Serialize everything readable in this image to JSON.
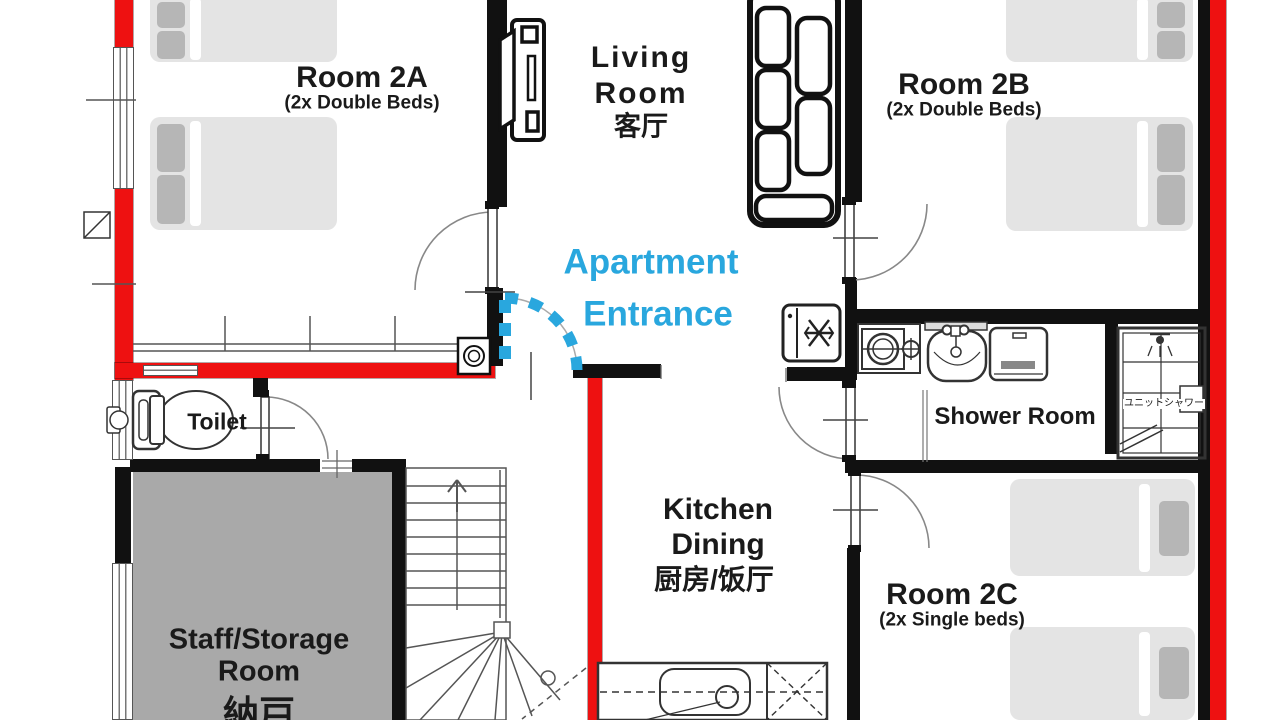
{
  "rooms": {
    "room_2a": {
      "name": "Room 2A",
      "subtitle": "(2x Double Beds)"
    },
    "living_room": {
      "name_line1": "Living",
      "name_line2": "Room",
      "name_cjk": "客厅"
    },
    "room_2b": {
      "name": "Room 2B",
      "subtitle": "(2x Double Beds)"
    },
    "room_2c": {
      "name": "Room 2C",
      "subtitle": "(2x Single beds)"
    },
    "kitchen_dining": {
      "name_line1": "Kitchen",
      "name_line2": "Dining",
      "name_cjk": "厨房/饭厅"
    },
    "toilet": {
      "name": "Toilet"
    },
    "shower_room": {
      "name": "Shower Room",
      "unit_shower_label": "ユニットシャワー"
    },
    "staff_storage": {
      "name_line1": "Staff/Storage",
      "name_line2": "Room",
      "name_cjk": "納戸"
    },
    "entrance": {
      "label_line1": "Apartment",
      "label_line2": "Entrance"
    }
  },
  "colors": {
    "exterior_wall_red": "#ee1111",
    "interior_wall_black": "#111111",
    "entrance_accent_blue": "#29a7de",
    "bed_fill": "#e4e4e4",
    "pillow_fill": "#b6b6b6",
    "storage_floor_gray": "#a9a9a9",
    "label_text": "#1a1a1a"
  },
  "icons": [
    "tv-icon",
    "sofa-icon",
    "refrigerator-icon",
    "snowflake-icon",
    "washing-machine-icon",
    "faucet-icon",
    "sink-icon",
    "dryer-icon",
    "shower-unit-icon",
    "shower-head-icon",
    "toilet-icon",
    "stairs-icon",
    "stairs-up-arrow-icon",
    "kitchen-counter-icon",
    "entrance-door-icon",
    "door-swing-icon",
    "vent-icon",
    "shoe-cabinet-icon",
    "window-marker",
    "bed-icon"
  ]
}
